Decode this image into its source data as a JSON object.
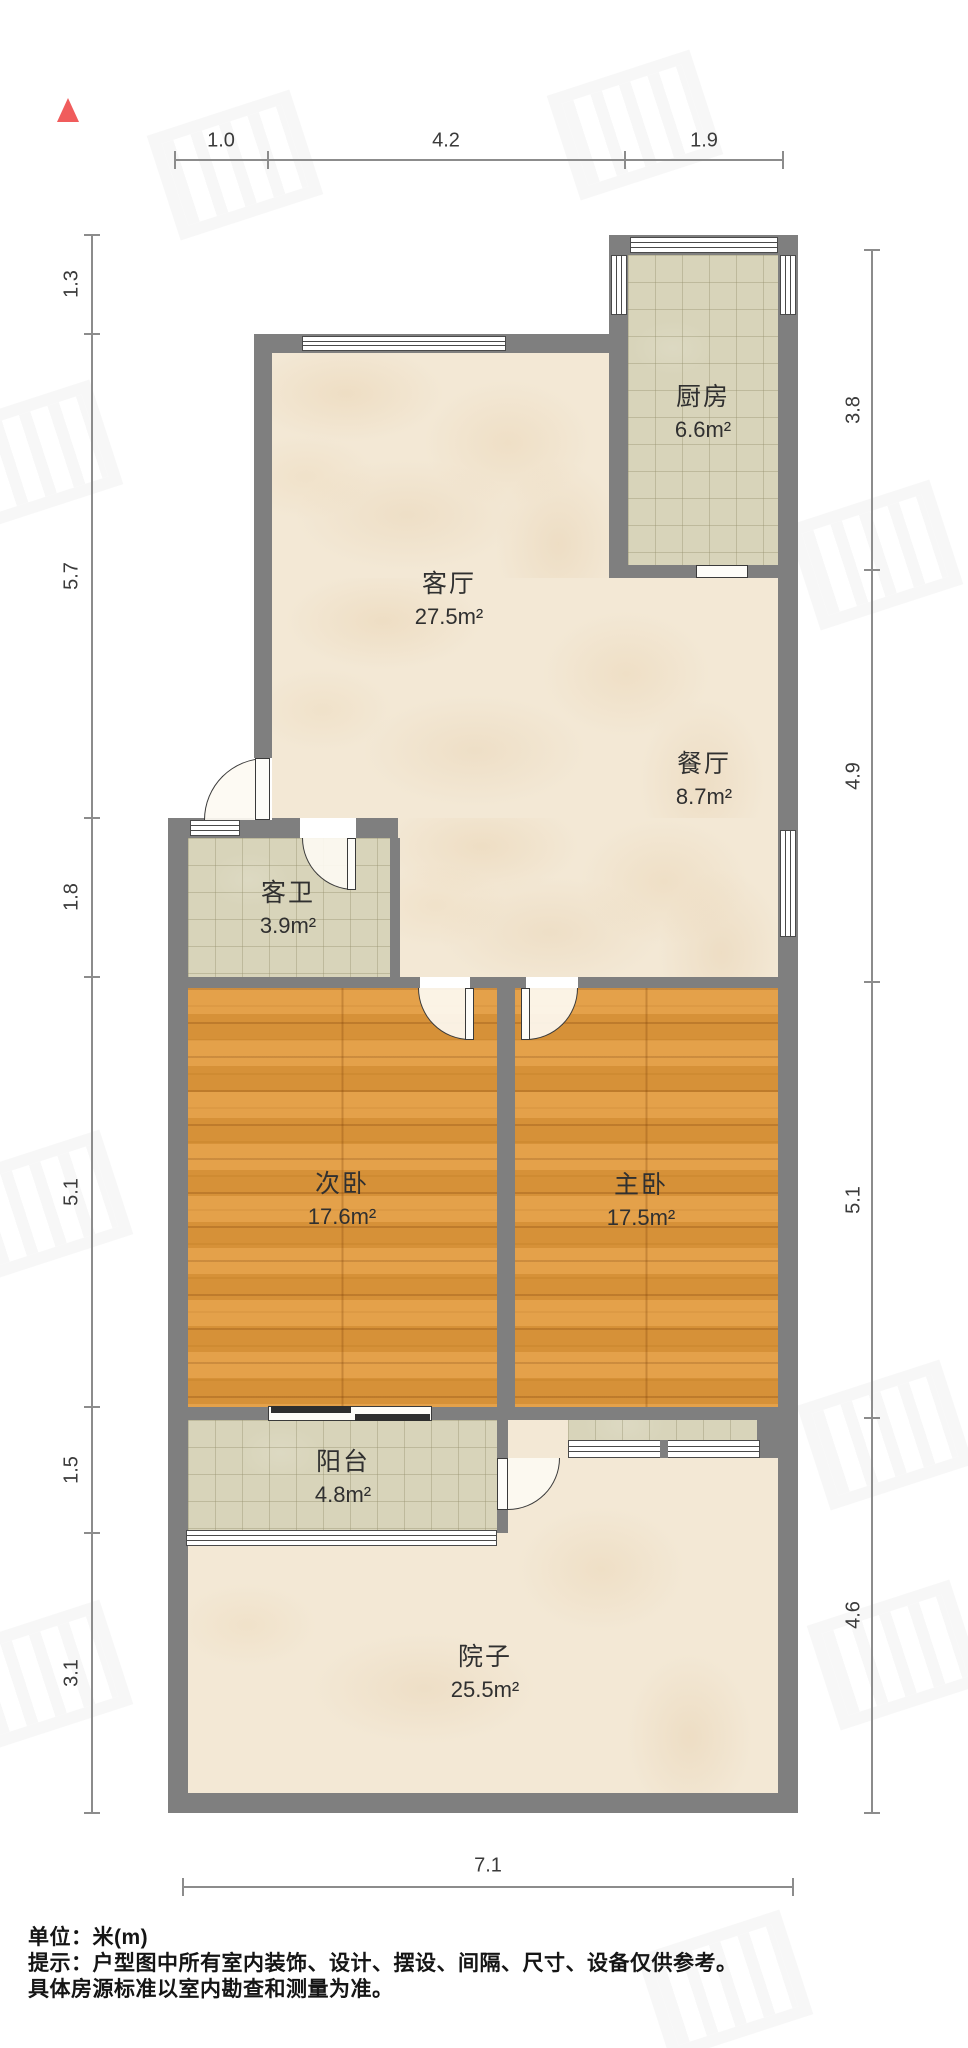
{
  "dimensions": {
    "top": [
      "1.0",
      "4.2",
      "1.9"
    ],
    "left": [
      "1.3",
      "5.7",
      "1.8",
      "5.1",
      "1.5",
      "3.1"
    ],
    "right": [
      "3.8",
      "4.9",
      "5.1",
      "4.6"
    ],
    "bottom": [
      "7.1"
    ]
  },
  "rooms": {
    "kitchen": {
      "label": "厨房",
      "area": "6.6m²"
    },
    "living": {
      "label": "客厅",
      "area": "27.5m²"
    },
    "dining": {
      "label": "餐厅",
      "area": "8.7m²"
    },
    "guest_bath": {
      "label": "客卫",
      "area": "3.9m²"
    },
    "second_bedroom": {
      "label": "次卧",
      "area": "17.6m²"
    },
    "master_bedroom": {
      "label": "主卧",
      "area": "17.5m²"
    },
    "balcony": {
      "label": "阳台",
      "area": "4.8m²"
    },
    "yard": {
      "label": "院子",
      "area": "25.5m²"
    }
  },
  "footer": {
    "unit_line": "单位：米(m)",
    "tip_line1": "提示：户型图中所有室内装饰、设计、摆设、间隔、尺寸、设备仅供参考。",
    "tip_line2": "具体房源标准以室内勘查和测量为准。"
  },
  "colors": {
    "wall": "#7f7f7f",
    "wood_floor": "#e2993b",
    "tile_floor": "#d8d4ba",
    "marble_floor": "#f3e8d5",
    "north_arrow": "#f05c5c"
  }
}
